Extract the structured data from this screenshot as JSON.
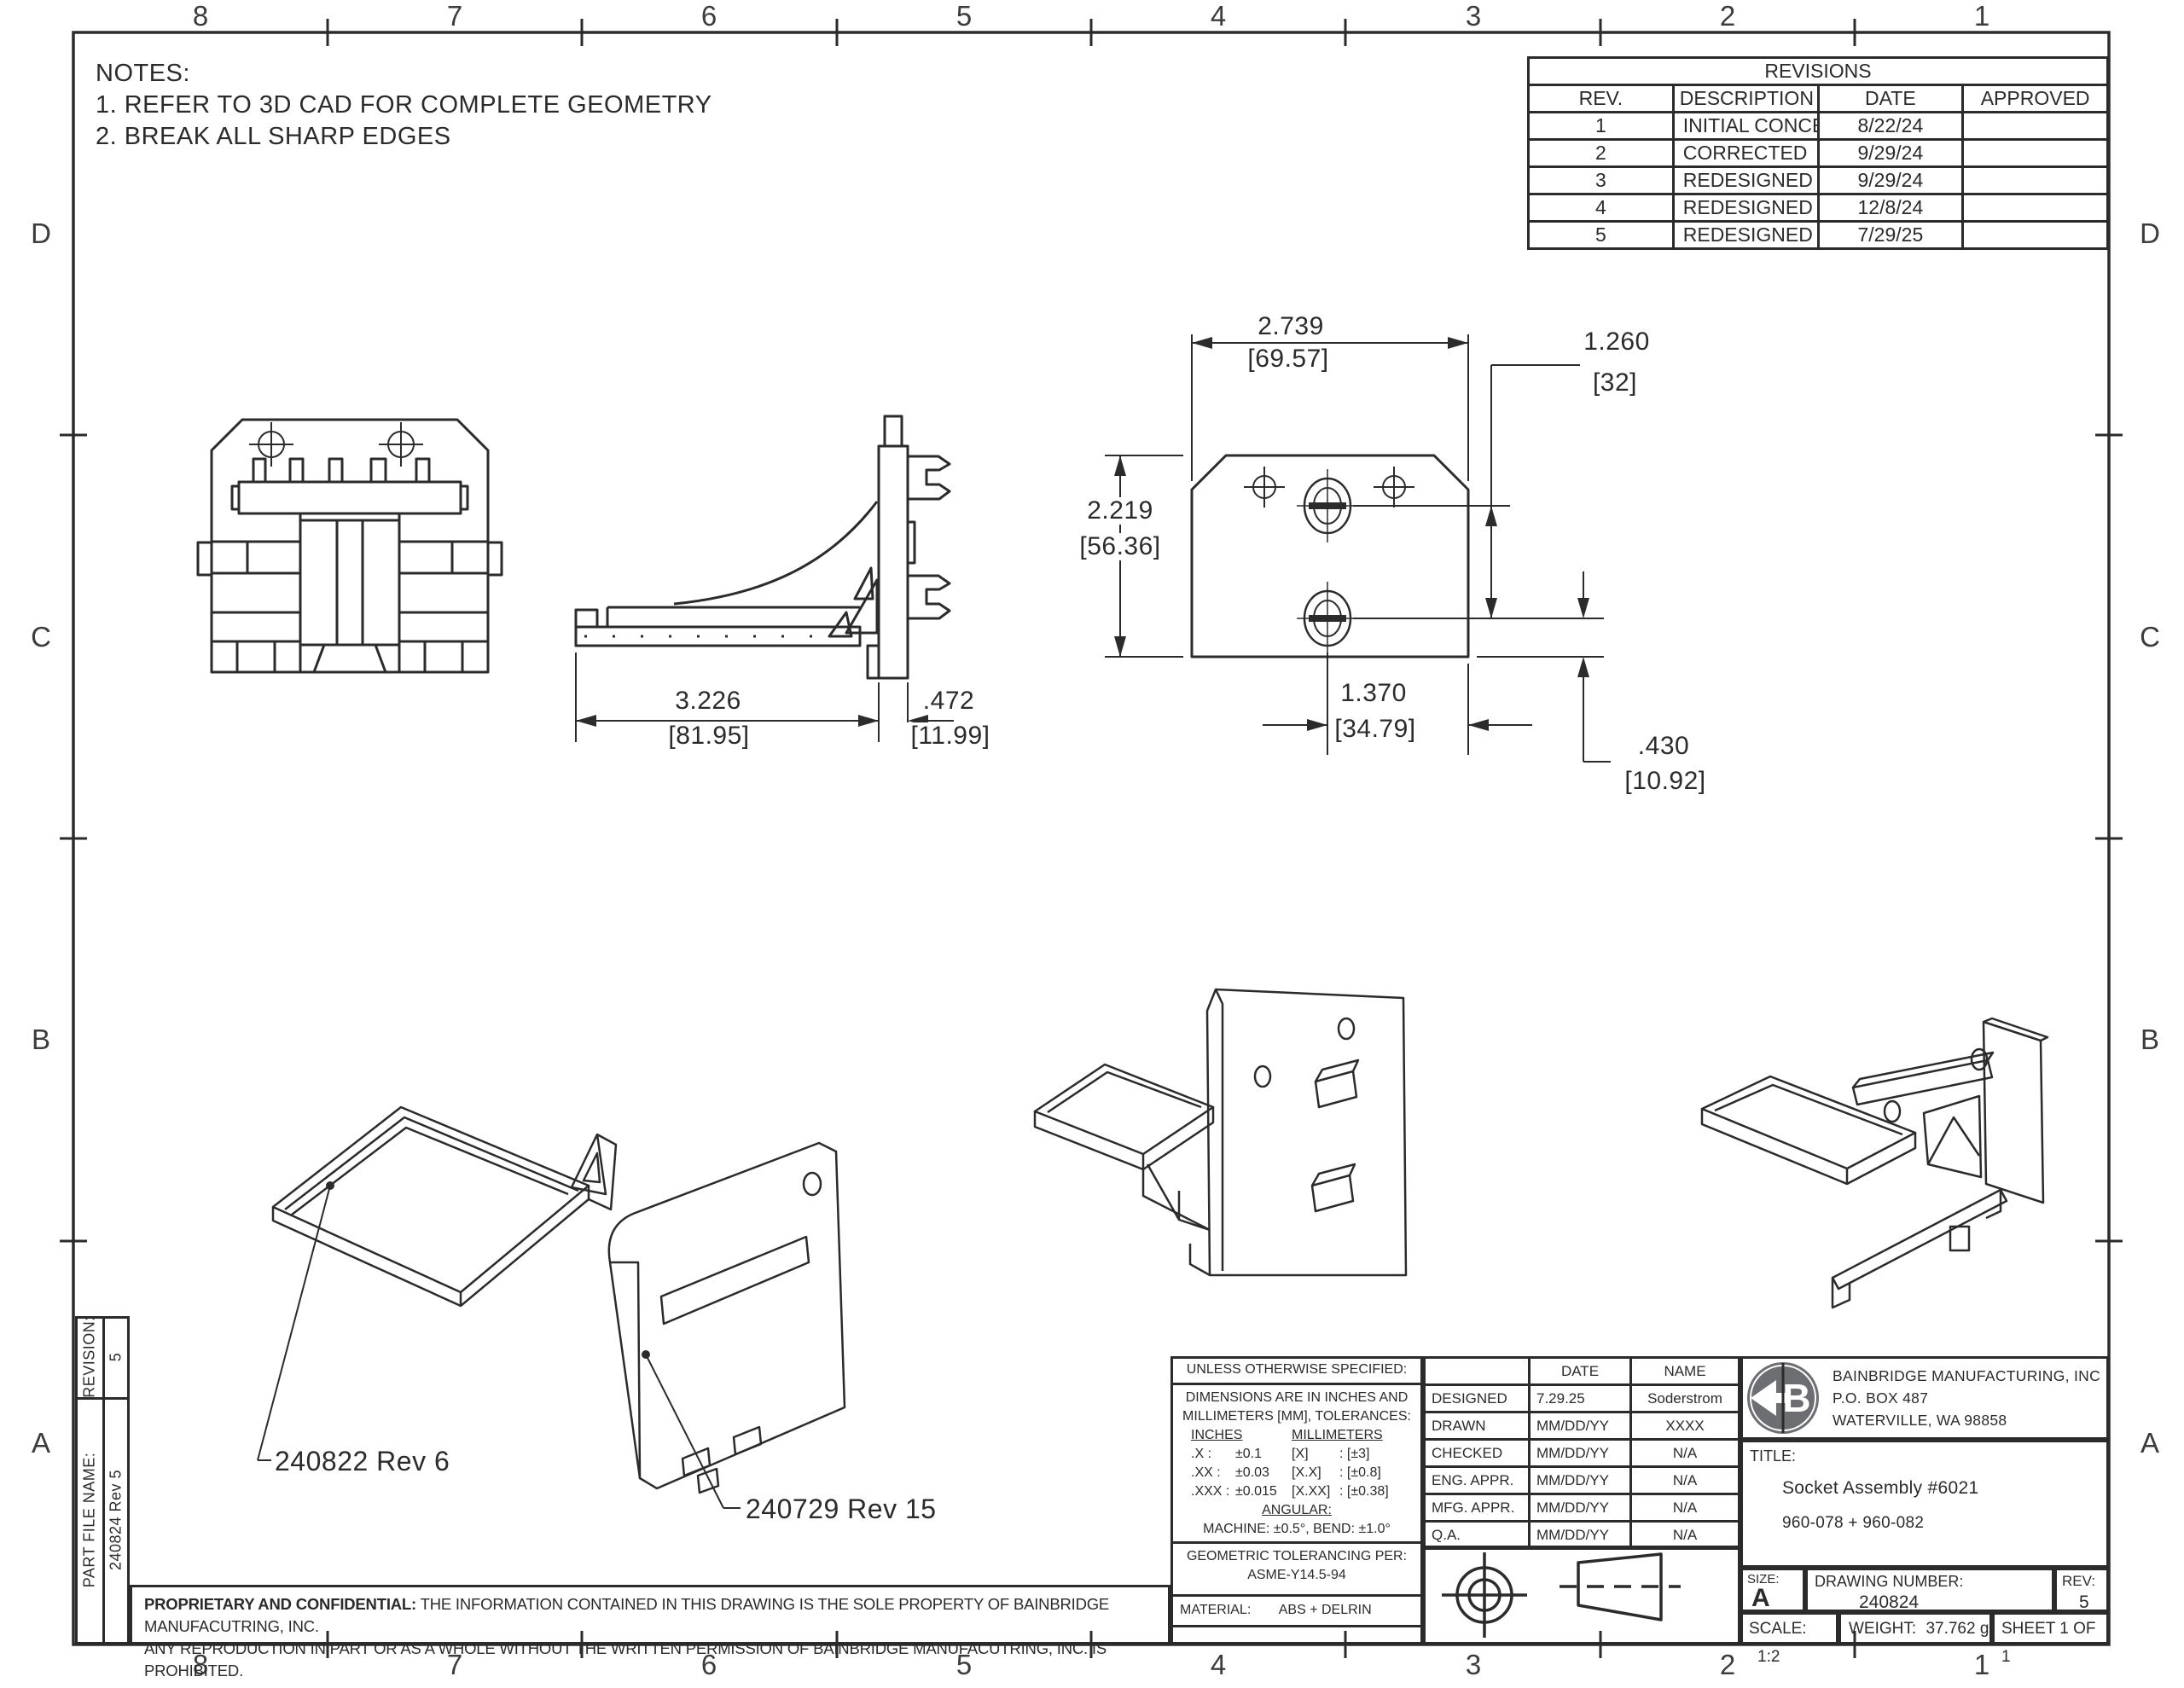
{
  "sheet": {
    "bg": "#ffffff",
    "line_color": "#2b2b2b",
    "logo_color": "#6d6e71"
  },
  "border": {
    "cols": [
      "8",
      "7",
      "6",
      "5",
      "4",
      "3",
      "2",
      "1"
    ],
    "rows": [
      "D",
      "C",
      "B",
      "A"
    ]
  },
  "notes": {
    "title": "NOTES:",
    "item1": "1.  REFER TO 3D CAD FOR COMPLETE GEOMETRY",
    "item2": "2.  BREAK ALL SHARP EDGES"
  },
  "revisions": {
    "title": "REVISIONS",
    "headers": [
      "REV.",
      "DESCRIPTION",
      "DATE",
      "APPROVED"
    ],
    "rows": [
      {
        "rev": "1",
        "description": "INITIAL CONCEPT",
        "date": "8/22/24",
        "approved": ""
      },
      {
        "rev": "2",
        "description": "CORRECTED",
        "date": "9/29/24",
        "approved": ""
      },
      {
        "rev": "3",
        "description": "REDESIGNED",
        "date": "9/29/24",
        "approved": ""
      },
      {
        "rev": "4",
        "description": "REDESIGNED",
        "date": "12/8/24",
        "approved": ""
      },
      {
        "rev": "5",
        "description": "REDESIGNED",
        "date": "7/29/25",
        "approved": ""
      }
    ]
  },
  "dims": {
    "plate_width": {
      "in": "2.739",
      "mm": "[69.57]"
    },
    "clip_spacing": {
      "in": "1.260",
      "mm": "[32]"
    },
    "plate_height": {
      "in": "2.219",
      "mm": "[56.36]"
    },
    "clip_to_edge": {
      "in": "1.370",
      "mm": "[34.79]"
    },
    "bottom_offset": {
      "in": ".430",
      "mm": "[10.92]"
    },
    "bracket_length": {
      "in": "3.226",
      "mm": "[81.95]"
    },
    "plate_thickness": {
      "in": ".472",
      "mm": "[11.99]"
    }
  },
  "part_labels": {
    "shelf": "240822 Rev 6",
    "plate": "240729 Rev 15"
  },
  "tolerances": {
    "header": "UNLESS OTHERWISE SPECIFIED:",
    "line1": "DIMENSIONS ARE IN INCHES AND",
    "line2": "MILLIMETERS [MM], TOLERANCES:",
    "inches_header": "INCHES",
    "mm_header": "MILLIMETERS",
    "rows": [
      {
        "in_label": ".X :",
        "in_val": "±0.1",
        "mm_label": "[X]",
        "mm_val": ": [±3]"
      },
      {
        "in_label": ".XX :",
        "in_val": "±0.03",
        "mm_label": "[X.X]",
        "mm_val": ": [±0.8]"
      },
      {
        "in_label": ".XXX :",
        "in_val": "±0.015",
        "mm_label": "[X.XX]",
        "mm_val": ": [±0.38]"
      }
    ],
    "angular_header": "ANGULAR:",
    "angular_value": "MACHINE: ±0.5°, BEND: ±1.0°",
    "geo_line1": "GEOMETRIC TOLERANCING PER:",
    "geo_line2": "ASME-Y14.5-94",
    "material_label": "MATERIAL:",
    "material_value": "ABS + DELRIN"
  },
  "approvals": {
    "date_header": "DATE",
    "name_header": "NAME",
    "rows": [
      {
        "label": "DESIGNED",
        "date": "7.29.25",
        "name": "Soderstrom"
      },
      {
        "label": "DRAWN",
        "date": "MM/DD/YY",
        "name": "XXXX"
      },
      {
        "label": "CHECKED",
        "date": "MM/DD/YY",
        "name": "N/A"
      },
      {
        "label": "ENG. APPR.",
        "date": "MM/DD/YY",
        "name": "N/A"
      },
      {
        "label": "MFG. APPR.",
        "date": "MM/DD/YY",
        "name": "N/A"
      },
      {
        "label": "Q.A.",
        "date": "MM/DD/YY",
        "name": "N/A"
      }
    ]
  },
  "company": {
    "name": "BAINBRIDGE MANUFACTURING, INC",
    "address1": "P.O. BOX 487",
    "address2": "WATERVILLE, WA 98858",
    "logo_letter": "B"
  },
  "title_block": {
    "title_label": "TITLE:",
    "title_line1": "Socket Assembly #6021",
    "title_line2": "960-078  +  960-082",
    "size_label": "SIZE:",
    "size_value": "A",
    "drawing_number_label": "DRAWING NUMBER:",
    "drawing_number_value": "240824",
    "rev_label": "REV:",
    "rev_value": "5",
    "scale_label": "SCALE:",
    "scale_value": "1:2",
    "weight_label": "WEIGHT:",
    "weight_value": "37.762 g",
    "sheet_label": "SHEET 1 OF 1"
  },
  "sidebar": {
    "revision_label": "REVISION:",
    "revision_value": "5",
    "part_file_label": "PART FILE NAME:",
    "part_file_value": "240824 Rev 5"
  },
  "proprietary": {
    "bold": "PROPRIETARY AND CONFIDENTIAL:",
    "line1": " THE INFORMATION CONTAINED IN THIS DRAWING IS THE SOLE PROPERTY OF BAINBRIDGE MANUFACUTRING, INC.",
    "line2": "ANY REPRODUCTION IN PART OR AS A WHOLE WITHOUT THE WRITTEN PERMISSION OF BAINBRIDGE MANUFACUTRING, INC. IS PROHIBITED."
  }
}
